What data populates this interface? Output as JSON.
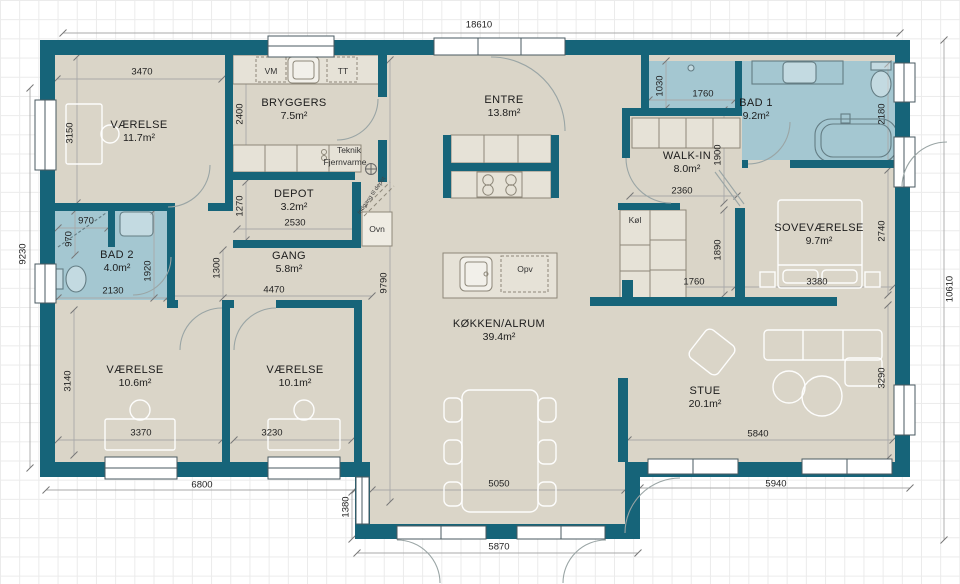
{
  "plan": {
    "rooms": [
      {
        "name": "VÆRELSE",
        "area": "11.7m²"
      },
      {
        "name": "BRYGGERS",
        "area": "7.5m²"
      },
      {
        "name": "DEPOT",
        "area": "3.2m²"
      },
      {
        "name": "BAD 2",
        "area": "4.0m²"
      },
      {
        "name": "GANG",
        "area": "5.8m²"
      },
      {
        "name": "VÆRELSE",
        "area": "10.6m²"
      },
      {
        "name": "VÆRELSE",
        "area": "10.1m²"
      },
      {
        "name": "ENTRE",
        "area": "13.8m²"
      },
      {
        "name": "KØKKEN/ALRUM",
        "area": "39.4m²"
      },
      {
        "name": "WALK-IN",
        "area": "8.0m²"
      },
      {
        "name": "BAD 1",
        "area": "9.2m²"
      },
      {
        "name": "SOVEVÆRELSE",
        "area": "9.7m²"
      },
      {
        "name": "STUE",
        "area": "20.1m²"
      }
    ],
    "labels": {
      "vm": "VM",
      "tt": "TT",
      "teknik": "Teknik",
      "fjernvarme": "Fjernvarme",
      "ovn": "Ovn",
      "kol": "Køl",
      "opv": "Opv",
      "indgang_depot": "Indgang til depot"
    },
    "dims": {
      "overall_top": "18610",
      "overall_left": "9230",
      "overall_right": "10610",
      "v1_w": "3470",
      "v1_h": "3150",
      "bryggers_h": "2400",
      "depot_h": "1270",
      "depot_w": "2530",
      "bad2_niche_w": "970",
      "bad2_niche_h": "970",
      "bad2_w": "2130",
      "bad2_h": "1920",
      "gang_h": "1300",
      "gang_w": "4470",
      "v2_h": "3140",
      "v2_w": "3370",
      "v3_w": "3230",
      "bottom_left": "6800",
      "kitchen_h": "9790",
      "bump_w": "5050",
      "bump_h": "1380",
      "bump_out": "5870",
      "bad1_niche_h": "1030",
      "bad1_niche_w": "1760",
      "bad1_h": "2180",
      "walkin_h": "1900",
      "walkin_w": "2360",
      "sov_h": "2740",
      "cab_h": "1890",
      "cab_w": "1760",
      "sov_w": "3380",
      "stue_h": "3290",
      "stue_w": "5840",
      "bottom_right": "5940"
    },
    "colors": {
      "wall": "#166479",
      "floor": "#dad5c8",
      "bath": "#a4c7d1"
    }
  }
}
